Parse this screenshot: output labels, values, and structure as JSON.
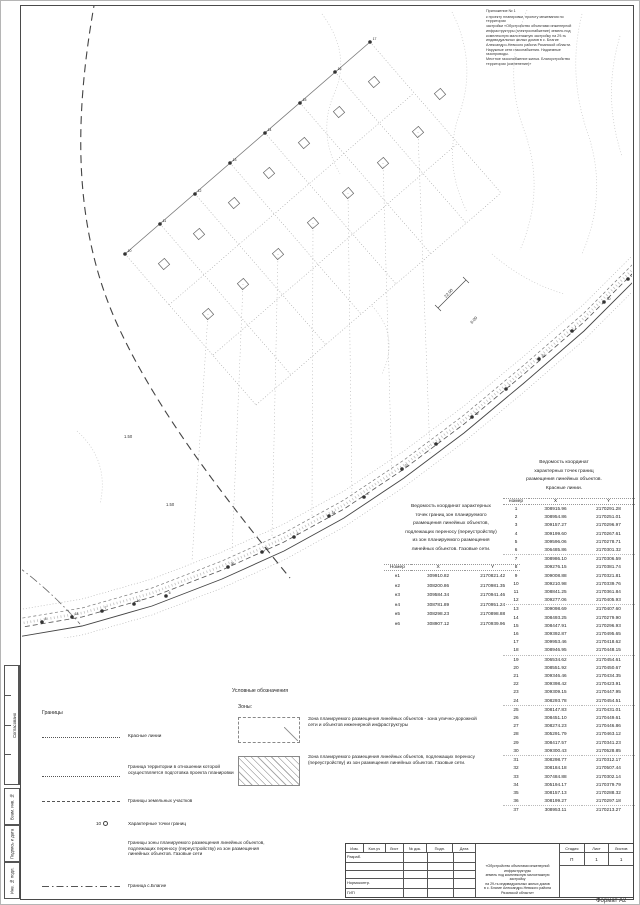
{
  "annotation": {
    "lines": [
      "Приложение № 1",
      "к проекту планировки, проекту межевания по территории",
      "застройки «Обустройство объектами инженерной",
      "инфраструктуры (электроснабжение) земель под",
      "комплексную малоэтажную застройку на 29-ть",
      "индивидуальных жилых домов в с. Благие",
      "Александро-Невского района Рязанской области.",
      "Наружные сети газоснабжения. Надземные газопроводы.",
      "Местное газоснабжение жилья. Благоустройство",
      "территории (озеленение)»"
    ]
  },
  "map": {
    "dims": {
      "d22": "22.00",
      "d6": "6.00",
      "d15a": "1.50",
      "d15b": "1.50"
    },
    "points": [
      {
        "x": 20,
        "y": 616,
        "n": "8"
      },
      {
        "x": 50,
        "y": 611,
        "n": "18"
      },
      {
        "x": 80,
        "y": 605,
        "n": "7"
      },
      {
        "x": 112,
        "y": 598,
        "n": "19"
      },
      {
        "x": 144,
        "y": 590,
        "n": "6"
      },
      {
        "x": 206,
        "y": 561,
        "n": "36"
      },
      {
        "x": 240,
        "y": 546,
        "n": "35"
      },
      {
        "x": 272,
        "y": 531,
        "n": "5"
      },
      {
        "x": 307,
        "y": 510,
        "n": "34"
      },
      {
        "x": 342,
        "y": 491,
        "n": "4"
      },
      {
        "x": 380,
        "y": 463,
        "n": "33"
      },
      {
        "x": 414,
        "y": 438,
        "n": "3"
      },
      {
        "x": 450,
        "y": 411,
        "n": "32"
      },
      {
        "x": 484,
        "y": 383,
        "n": "2"
      },
      {
        "x": 517,
        "y": 353,
        "n": "31"
      },
      {
        "x": 550,
        "y": 325,
        "n": "1"
      },
      {
        "x": 582,
        "y": 296,
        "n": "30"
      },
      {
        "x": 606,
        "y": 273,
        "n": "29"
      },
      {
        "x": 103,
        "y": 248,
        "n": "10"
      },
      {
        "x": 138,
        "y": 218,
        "n": "11"
      },
      {
        "x": 173,
        "y": 188,
        "n": "12"
      },
      {
        "x": 208,
        "y": 157,
        "n": "13"
      },
      {
        "x": 243,
        "y": 127,
        "n": "14"
      },
      {
        "x": 278,
        "y": 97,
        "n": "15"
      },
      {
        "x": 313,
        "y": 66,
        "n": "16"
      },
      {
        "x": 348,
        "y": 36,
        "n": "17"
      }
    ]
  },
  "gas_table": {
    "title_lines": [
      "Ведомость координат характерных",
      "точек границ зон планируемого",
      "размещения линейных объектов,",
      "подлежащих переносу (переустройству)",
      "из зон планируемого размещения",
      "линейных объектов. Газовые сети."
    ],
    "columns": [
      "Номер",
      "X",
      "Y"
    ],
    "rows": [
      [
        "н1",
        "309910.82",
        "2170821.42"
      ],
      [
        "н2",
        "308200.86",
        "2170981.35"
      ],
      [
        "н3",
        "309584.34",
        "2170941.46"
      ],
      [
        "н4",
        "308781.89",
        "2170951.24"
      ],
      [
        "н5",
        "308298.23",
        "2170898.88"
      ],
      [
        "н6",
        "308907.12",
        "2170939.96"
      ]
    ]
  },
  "red_table": {
    "title_lines": [
      "Ведомость координат",
      "характерных точек границ",
      "размещения линейных объектов.",
      "Красные линии."
    ],
    "columns": [
      "номер",
      "X",
      "Y"
    ],
    "rows": [
      [
        "1",
        "308915.96",
        "2170291.28"
      ],
      [
        "2",
        "308954.86",
        "2170251.01"
      ],
      [
        "3",
        "309157.27",
        "2170296.97"
      ],
      [
        "4",
        "309199.60",
        "2170267.61"
      ],
      [
        "5",
        "309596.06",
        "2170278.71"
      ],
      [
        "6",
        "306485.86",
        "2170301.32"
      ],
      [
        "7",
        "308986.10",
        "2170306.59"
      ],
      [
        "8",
        "309276.15",
        "2170381.74"
      ],
      [
        "9",
        "309008.88",
        "2170321.81"
      ],
      [
        "10",
        "309210.98",
        "2170339.76"
      ],
      [
        "11",
        "308841.25",
        "2170361.84"
      ],
      [
        "12",
        "309277.06",
        "2170405.93"
      ],
      [
        "13",
        "309098.69",
        "2170407.60"
      ],
      [
        "14",
        "308493.25",
        "2170279.90"
      ],
      [
        "15",
        "308447.91",
        "2170296.93"
      ],
      [
        "16",
        "309392.87",
        "2170495.65"
      ],
      [
        "17",
        "309953.46",
        "2170418.62"
      ],
      [
        "18",
        "308946.95",
        "2170448.15"
      ],
      [
        "19",
        "306534.62",
        "2170454.61"
      ],
      [
        "20",
        "308551.92",
        "2170450.67"
      ],
      [
        "21",
        "309346.46",
        "2170434.35"
      ],
      [
        "22",
        "309398.42",
        "2170423.91"
      ],
      [
        "23",
        "309309.15",
        "2170447.95"
      ],
      [
        "24",
        "308293.78",
        "2170454.51"
      ],
      [
        "25",
        "308147.83",
        "2170431.01"
      ],
      [
        "26",
        "308451.10",
        "2170449.61"
      ],
      [
        "27",
        "308274.23",
        "2170446.86"
      ],
      [
        "28",
        "305291.79",
        "2170463.12"
      ],
      [
        "29",
        "308417.57",
        "2170341.23"
      ],
      [
        "30",
        "309300.43",
        "2170528.85"
      ],
      [
        "31",
        "308298.77",
        "2170312.17"
      ],
      [
        "32",
        "308184.18",
        "2170507.44"
      ],
      [
        "33",
        "307484.88",
        "2170302.14"
      ],
      [
        "34",
        "305194.17",
        "2170379.79"
      ],
      [
        "35",
        "308157.13",
        "2170288.32"
      ],
      [
        "36",
        "308199.27",
        "2170297.18"
      ],
      [
        "37",
        "308953.11",
        "2170213.27"
      ]
    ]
  },
  "legend": {
    "heading": "Условные обозначения",
    "groups_label": "Границы",
    "items": [
      {
        "label": "Красные линии"
      },
      {
        "label": "Граница территории в отношении которой осуществляется подготовка проекта планировки"
      },
      {
        "label": "Границы земельных участков"
      },
      {
        "symbol": "10",
        "label": "Характерные точки границ"
      },
      {
        "label": "Границы зоны планируемого размещения линейных объектов, подлежащих переносу (переустройству) из зон размещения линейных объектов. Газовые сети"
      },
      {
        "label": "Граница с.Благие"
      }
    ],
    "zones_label": "Зоны:",
    "zones": [
      {
        "label": "Зона планируемого размещения линейных объектов - зона улично-дорожной сети и объектов инженерной инфраструктуры"
      },
      {
        "label": "Зона планируемого размещения линейных объектов, подлежащих переносу (переустройству) из зон размещения линейных объектов. Газовые сети."
      }
    ]
  },
  "stamp": {
    "header_cols": [
      "Изм.",
      "Кол.уч",
      "Лист",
      "№ док.",
      "Подп.",
      "Дата"
    ],
    "row_labels": [
      "Разраб.",
      "",
      "",
      "Нормоконтр.",
      "ГИП"
    ],
    "title_lines": [
      "«Обустройство объектами инженерной инфраструктуры",
      "земель под комплексную малоэтажную застройку",
      "на 29-ть индивидуальных жилых домов",
      "в с. Благие Александро-Невского района",
      "Рязанской области»"
    ],
    "stage_label": "Стадия",
    "sheet_label": "Лист",
    "sheets_label": "Листов",
    "stage": "П",
    "sheet": "1",
    "sheets": "1"
  },
  "side_strip": {
    "approval": "Согласовано",
    "items": [
      "Взам. инв. №",
      "Подпись и дата",
      "Инв. № подл."
    ]
  },
  "format_label": "Формат А2"
}
